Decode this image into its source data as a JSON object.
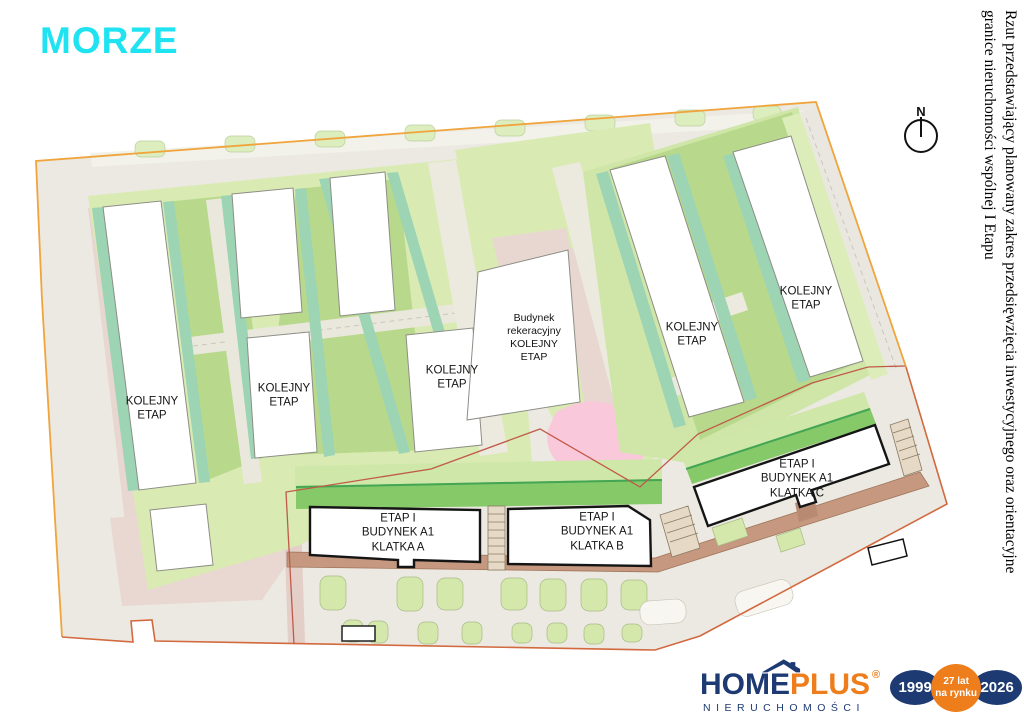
{
  "title": "MORZE",
  "side_note": {
    "text": "Rzut przedstawiający planowany zakres przedsięwzięcia inwestycyjnego oraz orientacyjne\ngranice nieruchomości wspólnej I Etapu"
  },
  "compass": {
    "north_label": "N"
  },
  "plan": {
    "labels": [
      {
        "id": "kolejny-etap-1",
        "text": "KOLEJNY\nETAP"
      },
      {
        "id": "kolejny-etap-2",
        "text": "KOLEJNY\nETAP"
      },
      {
        "id": "kolejny-etap-3",
        "text": "KOLEJNY\nETAP"
      },
      {
        "id": "budynek-rekreacyjny",
        "text": "Budynek\nrekeracyjny\nKOLEJNY\nETAP"
      },
      {
        "id": "kolejny-etap-4",
        "text": "KOLEJNY\nETAP"
      },
      {
        "id": "kolejny-etap-5",
        "text": "KOLEJNY\nETAP"
      },
      {
        "id": "etap1-klatka-a",
        "text": "ETAP I\nBUDYNEK A1\nKLATKA A"
      },
      {
        "id": "etap1-klatka-b",
        "text": "ETAP I\nBUDYNEK A1\nKLATKA B"
      },
      {
        "id": "etap1-klatka-c",
        "text": "ETAP I\nBUDYNEK A1\nKLATKA C"
      }
    ]
  },
  "logo": {
    "name_part1": "HOME",
    "name_part2": "PLUS",
    "registered": "®",
    "subtitle": "NIERUCHOMOŚCI",
    "badge_year_start": "1999",
    "badge_center": "27 lat\nna rynku",
    "badge_year_end": "2026"
  },
  "colors": {
    "title_cyan": "#1fe3f1",
    "brand_navy": "#1e3a73",
    "brand_orange": "#ee7d1c",
    "site_boundary_orange": "#f0a43c",
    "stage1_boundary_red": "#c05a48"
  }
}
